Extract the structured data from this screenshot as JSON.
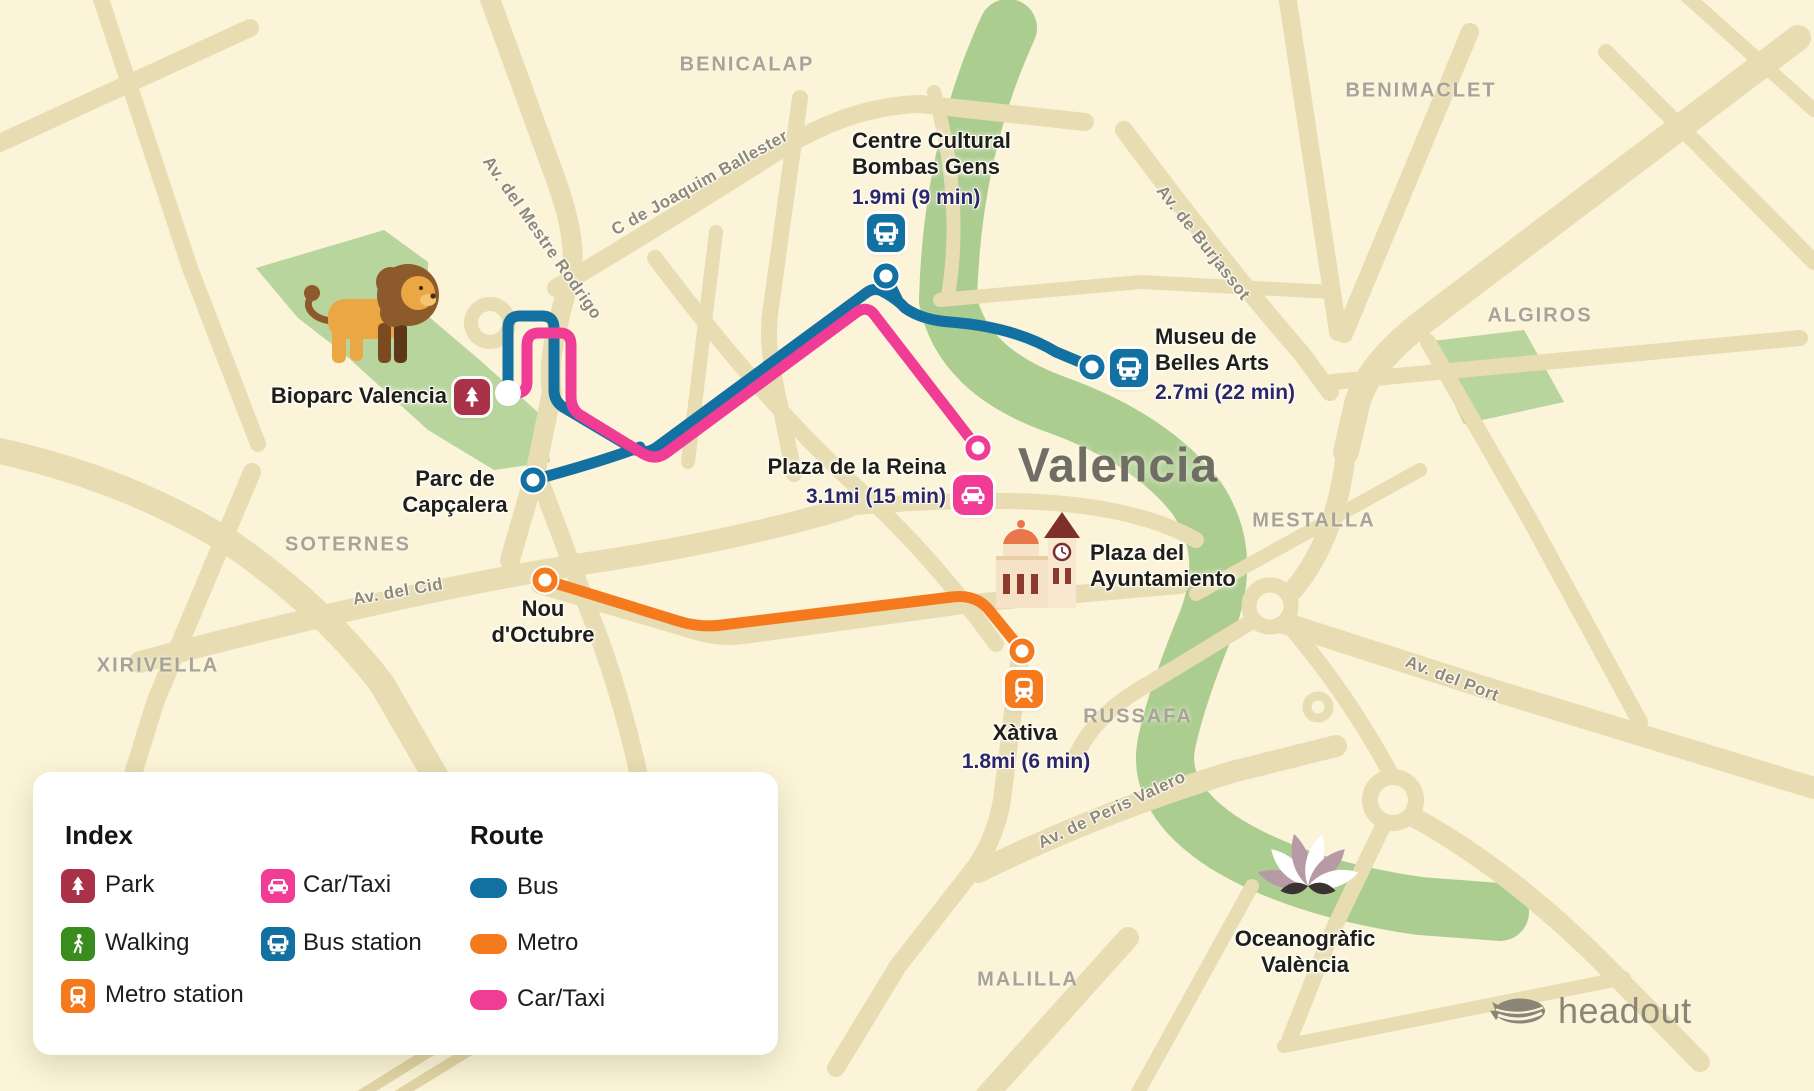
{
  "city": {
    "label": "Valencia"
  },
  "districts": [
    {
      "id": "benicalap",
      "label": "BENICALAP"
    },
    {
      "id": "benimaclet",
      "label": "BENIMACLET"
    },
    {
      "id": "algiros",
      "label": "ALGIROS"
    },
    {
      "id": "soternes",
      "label": "SOTERNES"
    },
    {
      "id": "xirivella",
      "label": "XIRIVELLA"
    },
    {
      "id": "mestalla",
      "label": "MESTALLA"
    },
    {
      "id": "russafa",
      "label": "RUSSAFA"
    },
    {
      "id": "malilla",
      "label": "MALILLA"
    }
  ],
  "streets": [
    {
      "id": "mestre-rodrigo",
      "label": "Av. del Mestre Rodrigo"
    },
    {
      "id": "joaquim-ballester",
      "label": "C de Joaquim Ballester"
    },
    {
      "id": "burjassot",
      "label": "Av. de Burjassot"
    },
    {
      "id": "cid",
      "label": "Av. del Cid"
    },
    {
      "id": "port",
      "label": "Av. del Port"
    },
    {
      "id": "peris-valero",
      "label": "Av. de Peris Valero"
    }
  ],
  "pois": {
    "bioparc": {
      "name": "Bioparc Valencia"
    },
    "parc_capcalera": {
      "name": "Parc de\nCapçalera"
    },
    "bombas_gens": {
      "name": "Centre Cultural\nBombas Gens",
      "distance": "1.9mi (9 min)",
      "mode": "bus"
    },
    "belles_arts": {
      "name": "Museu de\nBelles Arts",
      "distance": "2.7mi (22 min)",
      "mode": "bus"
    },
    "plaza_reina": {
      "name": "Plaza de la Reina",
      "distance": "3.1mi (15 min)",
      "mode": "car-taxi"
    },
    "ayuntamiento": {
      "name": "Plaza del\nAyuntamiento"
    },
    "nou_octubre": {
      "name": "Nou\nd'Octubre"
    },
    "xativa": {
      "name": "Xàtiva",
      "distance": "1.8mi (6 min)",
      "mode": "metro"
    },
    "oceanografic": {
      "name": "Oceanogràfic\nValència"
    }
  },
  "legend": {
    "index_title": "Index",
    "route_title": "Route",
    "index_items": [
      {
        "id": "park",
        "label": "Park",
        "color": "#a93249"
      },
      {
        "id": "walking",
        "label": "Walking",
        "color": "#3a8c1e"
      },
      {
        "id": "metro-station",
        "label": "Metro station",
        "color": "#f5791d"
      },
      {
        "id": "car-taxi",
        "label": "Car/Taxi",
        "color": "#f03c94"
      },
      {
        "id": "bus-station",
        "label": "Bus station",
        "color": "#1371a1"
      }
    ],
    "route_items": [
      {
        "id": "bus",
        "label": "Bus",
        "color": "#1371a1"
      },
      {
        "id": "metro",
        "label": "Metro",
        "color": "#f5791d"
      },
      {
        "id": "car-taxi",
        "label": "Car/Taxi",
        "color": "#f03c94"
      }
    ]
  },
  "brand": {
    "name": "headout"
  },
  "colors": {
    "bus_route": "#1371a1",
    "metro_route": "#f5791d",
    "car_taxi_route": "#f03c94",
    "park_badge": "#a93249",
    "walking_badge": "#3a8c1e",
    "map_background": "#fbf4d8",
    "street": "#e7dcb2",
    "green_area": "#b7d59c",
    "district_label": "#a7a399",
    "distance_text": "#2b2769",
    "brand_gray": "#8b8578"
  }
}
